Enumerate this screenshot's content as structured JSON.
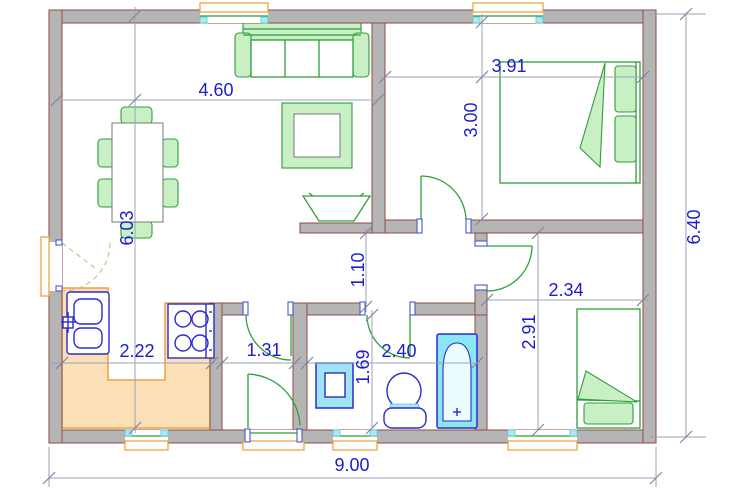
{
  "plan": {
    "type": "architectural-floor-plan",
    "dimensions_m": {
      "living_width": "4.60",
      "bedroom1_width": "3.91",
      "bedroom1_depth": "3.00",
      "house_depth": "6.40",
      "living_depth": "6.03",
      "hall_width": "1.10",
      "bedroom2_width": "2.34",
      "bedroom2_depth": "2.91",
      "kitchen_width": "2.22",
      "closet_width": "1.31",
      "bathroom_depth": "1.69",
      "bathroom_width": "2.40",
      "house_width": "9.00"
    },
    "fixtures": [
      "sofa",
      "tv",
      "coffee-table",
      "dining-table",
      "chairs",
      "kitchen-counter",
      "kitchen-sink",
      "stove",
      "double-bed",
      "single-bed",
      "washbasin",
      "toilet",
      "bathtub"
    ],
    "openings": [
      "entry-door",
      "back-door",
      "bedroom1-door",
      "bedroom2-door",
      "bathroom-door",
      "closet-door",
      "living-window",
      "bedroom1-window",
      "kitchen-window",
      "wc-window",
      "bedroom2-window"
    ],
    "colors": {
      "wall_fill": "#b5b5b5",
      "wall_edge": "#8e4a44",
      "furniture_stroke": "#2f9e3c",
      "furniture_fill": "#c9efc4",
      "counter_fill": "#fbdfb7",
      "counter_edge": "#efa33f",
      "fixture_blue": "#2b2bd0",
      "tub_fill": "#8ae6f0",
      "glass_cyan": "#aee9f2",
      "dimension_text": "#1c1cce",
      "dimension_line": "#9aa3b8"
    }
  }
}
